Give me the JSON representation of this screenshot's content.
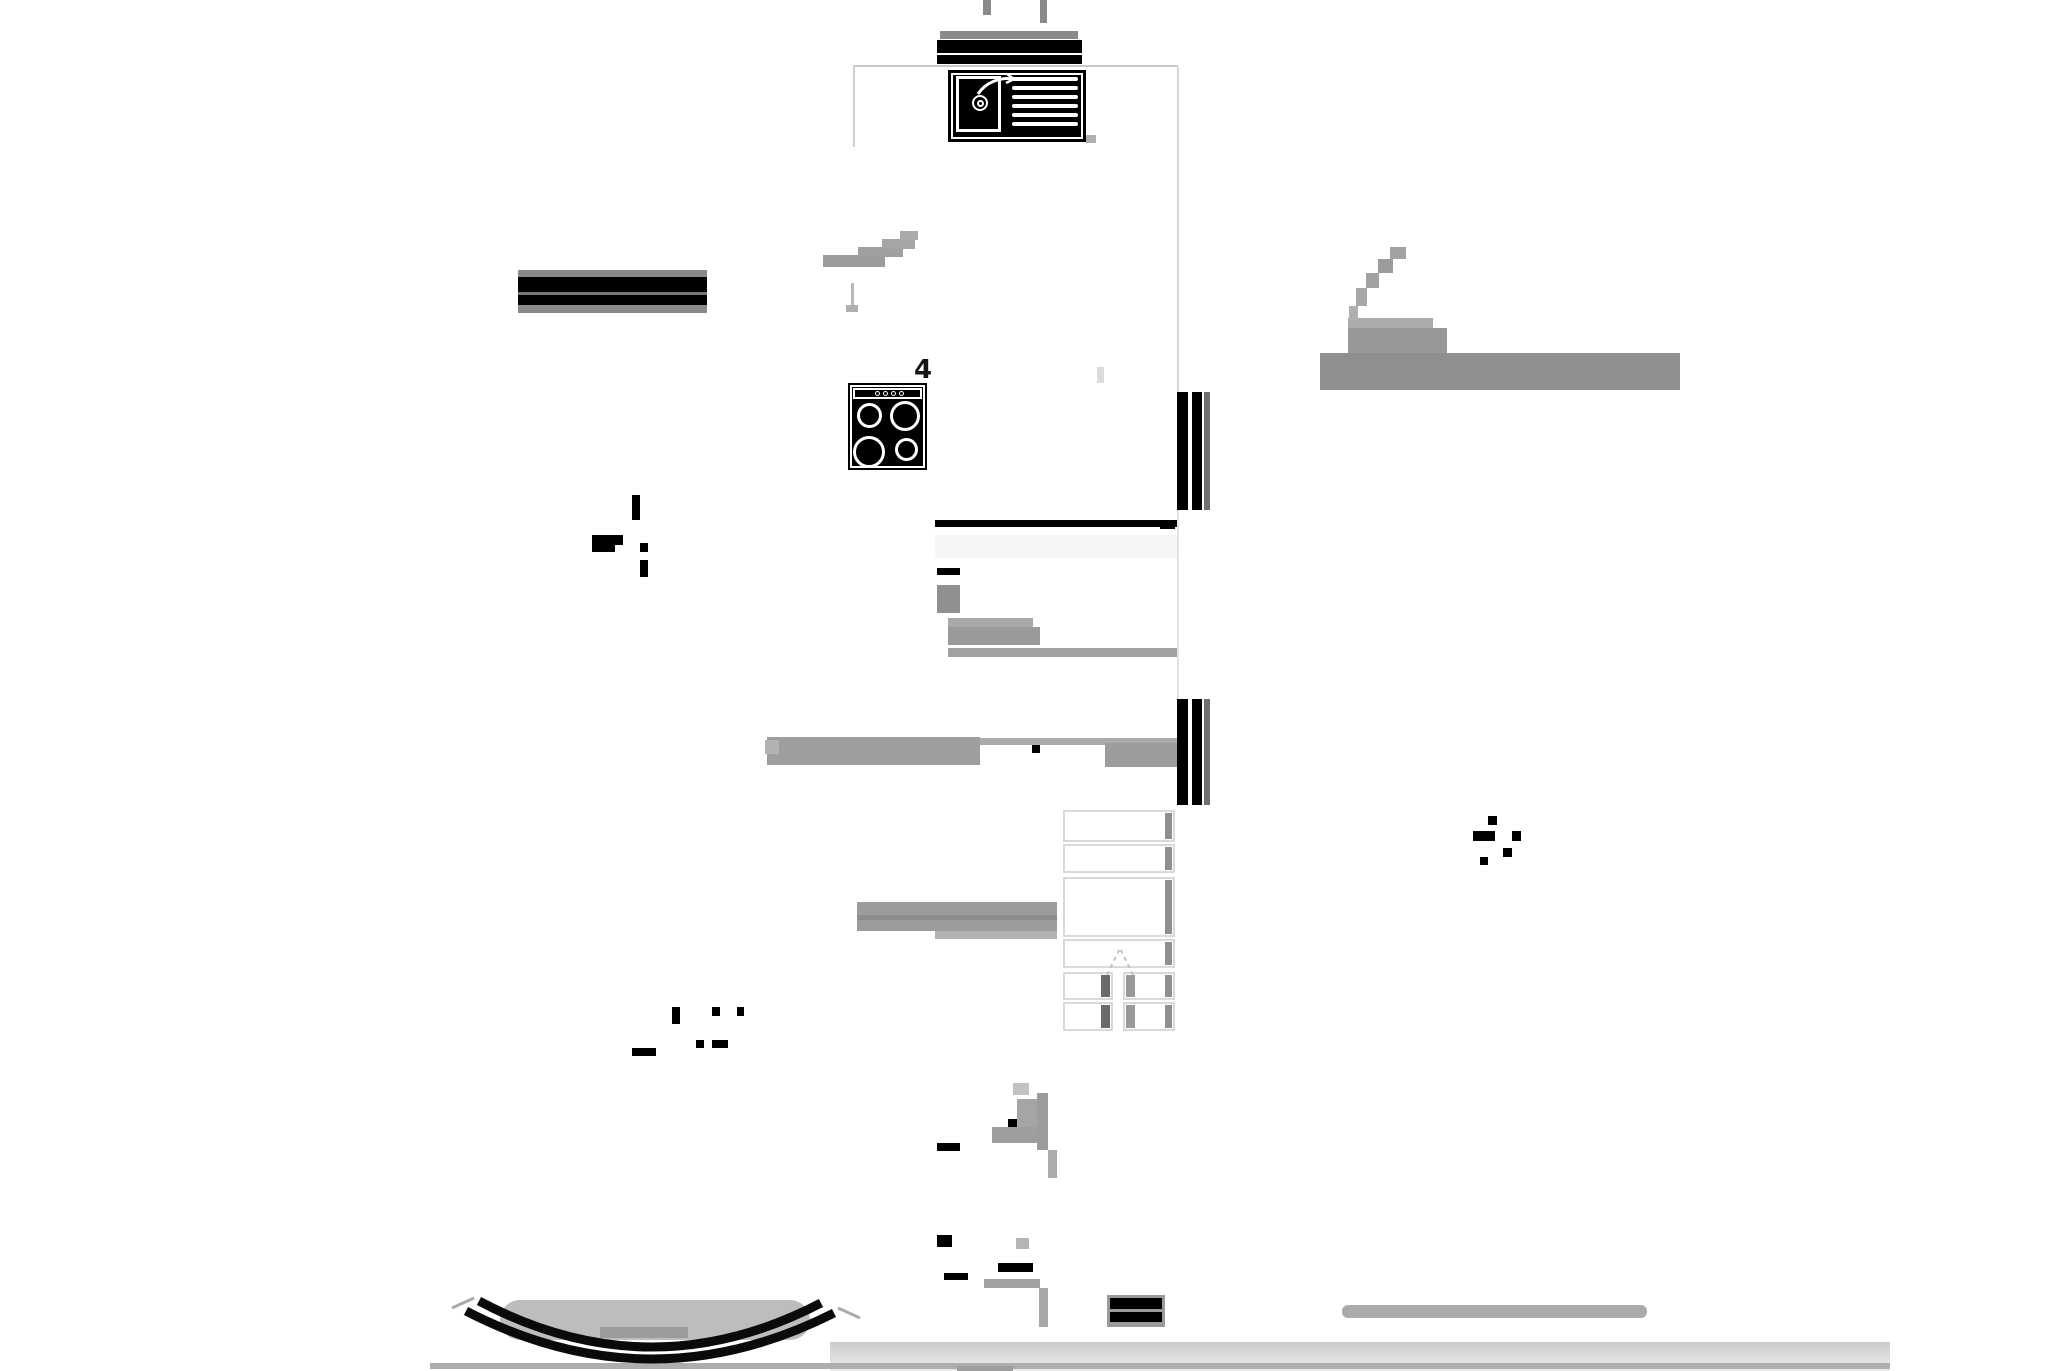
{
  "document": {
    "kind": "architectural-floor-plan",
    "colors": {
      "ink": "#000000",
      "wall_gray": "#8a8a8a",
      "smudge_gray": "#9a9a9a",
      "outline_light": "#c8c8c8",
      "band_gray": "#d0d0d0",
      "background": "#ffffff"
    }
  },
  "plan": {
    "room_label": "4",
    "symbols": {
      "sink": "kitchen-sink-with-drainboard",
      "stove": "four-burner-stove",
      "stairs": "staircase-with-up-chevron",
      "curved_wall": "curved-bay-wall-double-arc",
      "window": "double-line-window-segment"
    },
    "sink": {
      "drainboard_line_count": 6,
      "drain": "double-circle",
      "faucet": "swing-spout"
    },
    "stove": {
      "burner_count": 4,
      "knob_count": 4
    }
  },
  "stairs": {
    "x": 1063,
    "width": 112,
    "left_cell_w": 50,
    "right_cell_x": 60,
    "right_cell_w": 52,
    "rows": [
      {
        "y": 810,
        "h": 32,
        "split": false
      },
      {
        "y": 844,
        "h": 29,
        "split": false
      },
      {
        "y": 877,
        "h": 60,
        "split": false
      },
      {
        "y": 939,
        "h": 29,
        "split": false
      },
      {
        "y": 972,
        "h": 28,
        "split": true
      },
      {
        "y": 1002,
        "h": 29,
        "split": true
      }
    ]
  },
  "ink_marks": [
    [
      632,
      495,
      8,
      25
    ],
    [
      592,
      535,
      31,
      10
    ],
    [
      592,
      545,
      23,
      7
    ],
    [
      640,
      543,
      8,
      9
    ],
    [
      640,
      560,
      8,
      17
    ],
    [
      1488,
      816,
      9,
      9
    ],
    [
      1473,
      831,
      22,
      10
    ],
    [
      1512,
      831,
      9,
      10
    ],
    [
      1503,
      848,
      9,
      9
    ],
    [
      1480,
      857,
      8,
      8
    ],
    [
      672,
      1007,
      8,
      17
    ],
    [
      712,
      1007,
      8,
      9
    ],
    [
      737,
      1007,
      7,
      9
    ],
    [
      696,
      1040,
      8,
      8
    ],
    [
      712,
      1040,
      16,
      8
    ],
    [
      632,
      1048,
      24,
      8
    ],
    [
      937,
      568,
      23,
      7
    ],
    [
      1160,
      520,
      15,
      9
    ],
    [
      1032,
      745,
      8,
      8
    ],
    [
      937,
      1235,
      15,
      12
    ],
    [
      944,
      1273,
      24,
      7
    ],
    [
      998,
      1263,
      35,
      9
    ],
    [
      1008,
      1119,
      32,
      8
    ],
    [
      937,
      1143,
      23,
      8
    ]
  ],
  "smudges": [
    {
      "x": 1320,
      "y": 353,
      "w": 360,
      "h": 37,
      "c": "#8f8f8f"
    },
    {
      "x": 1348,
      "y": 328,
      "w": 99,
      "h": 25,
      "c": "#989898"
    },
    {
      "x": 1348,
      "y": 318,
      "w": 85,
      "h": 10,
      "c": "#ababab"
    },
    {
      "x": 1390,
      "y": 247,
      "w": 16,
      "h": 12,
      "c": "#a2a2a2"
    },
    {
      "x": 1378,
      "y": 259,
      "w": 15,
      "h": 14,
      "c": "#9c9c9c"
    },
    {
      "x": 1366,
      "y": 273,
      "w": 13,
      "h": 15,
      "c": "#a2a2a2"
    },
    {
      "x": 1356,
      "y": 288,
      "w": 11,
      "h": 18,
      "c": "#a8a8a8"
    },
    {
      "x": 1349,
      "y": 306,
      "w": 9,
      "h": 14,
      "c": "#b0b0b0"
    },
    {
      "x": 823,
      "y": 255,
      "w": 62,
      "h": 12,
      "c": "#9c9c9c"
    },
    {
      "x": 858,
      "y": 247,
      "w": 45,
      "h": 10,
      "c": "#a0a0a0"
    },
    {
      "x": 882,
      "y": 239,
      "w": 33,
      "h": 10,
      "c": "#a5a5a5"
    },
    {
      "x": 900,
      "y": 231,
      "w": 18,
      "h": 9,
      "c": "#aaaaaa"
    },
    {
      "x": 851,
      "y": 283,
      "w": 3,
      "h": 24,
      "c": "#b8b8b8"
    },
    {
      "x": 846,
      "y": 305,
      "w": 12,
      "h": 7,
      "c": "#b0b0b0"
    },
    {
      "x": 937,
      "y": 585,
      "w": 23,
      "h": 28,
      "c": "#8f8f8f"
    },
    {
      "x": 948,
      "y": 618,
      "w": 85,
      "h": 9,
      "c": "#a8a8a8"
    },
    {
      "x": 948,
      "y": 627,
      "w": 92,
      "h": 18,
      "c": "#9a9a9a"
    },
    {
      "x": 948,
      "y": 648,
      "w": 229,
      "h": 9,
      "c": "#a2a2a2"
    },
    {
      "x": 767,
      "y": 737,
      "w": 213,
      "h": 28,
      "c": "#9e9e9e"
    },
    {
      "x": 980,
      "y": 738,
      "w": 197,
      "h": 7,
      "c": "#ababab"
    },
    {
      "x": 1105,
      "y": 743,
      "w": 72,
      "h": 24,
      "c": "#9c9c9c"
    },
    {
      "x": 765,
      "y": 740,
      "w": 14,
      "h": 14,
      "c": "#b2b2b2"
    },
    {
      "x": 857,
      "y": 902,
      "w": 200,
      "h": 29,
      "c": "#9c9c9c"
    },
    {
      "x": 857,
      "y": 915,
      "w": 200,
      "h": 5,
      "c": "#8d8d8d"
    },
    {
      "x": 935,
      "y": 931,
      "w": 122,
      "h": 8,
      "c": "#b2b2b2"
    },
    {
      "x": 992,
      "y": 1127,
      "w": 56,
      "h": 16,
      "c": "#9e9e9e"
    },
    {
      "x": 1017,
      "y": 1099,
      "w": 31,
      "h": 28,
      "c": "#a5a5a5"
    },
    {
      "x": 1037,
      "y": 1093,
      "w": 11,
      "h": 57,
      "c": "#9c9c9c"
    },
    {
      "x": 1048,
      "y": 1150,
      "w": 9,
      "h": 28,
      "c": "#ababab"
    },
    {
      "x": 1013,
      "y": 1083,
      "w": 16,
      "h": 12,
      "c": "#c2c2c2"
    },
    {
      "x": 984,
      "y": 1279,
      "w": 56,
      "h": 9,
      "c": "#a2a2a2"
    },
    {
      "x": 1039,
      "y": 1288,
      "w": 9,
      "h": 39,
      "c": "#a8a8a8"
    },
    {
      "x": 1016,
      "y": 1238,
      "w": 13,
      "h": 11,
      "c": "#b5b5b5"
    },
    {
      "x": 1342,
      "y": 1305,
      "w": 305,
      "h": 13,
      "c": "#ababab",
      "r": 6
    },
    {
      "x": 500,
      "y": 1300,
      "w": 310,
      "h": 40,
      "c": "#bdbdbd",
      "r": 20
    },
    {
      "x": 600,
      "y": 1327,
      "w": 88,
      "h": 11,
      "c": "#9c9c9c"
    },
    {
      "x": 957,
      "y": 1366,
      "w": 56,
      "h": 5,
      "c": "#9e9e9e"
    },
    {
      "x": 1086,
      "y": 135,
      "w": 10,
      "h": 8,
      "c": "#b0b0b0"
    },
    {
      "x": 983,
      "y": 0,
      "w": 8,
      "h": 15,
      "c": "#8a8a8a"
    },
    {
      "x": 1040,
      "y": 0,
      "w": 7,
      "h": 23,
      "c": "#8a8a8a"
    },
    {
      "x": 1097,
      "y": 367,
      "w": 7,
      "h": 16,
      "c": "#dcdcdc"
    }
  ]
}
